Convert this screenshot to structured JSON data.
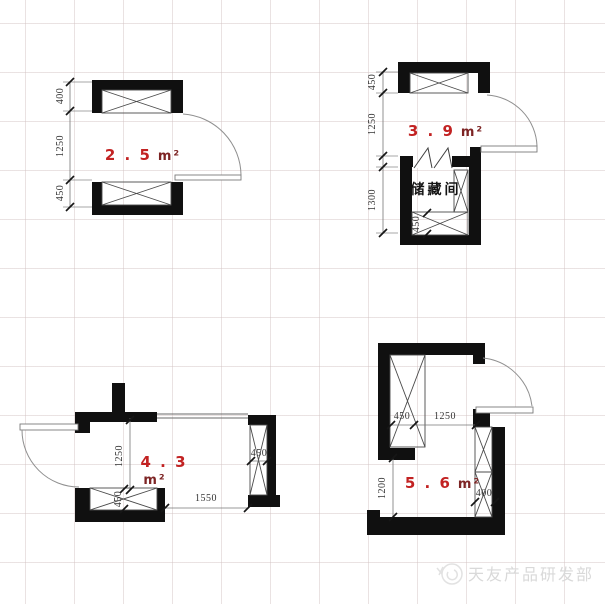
{
  "colors": {
    "wall_black": "#101010",
    "area_red": "#c22222",
    "area_unit_maroon": "#7d2424",
    "dim_text": "#353535",
    "grid_line": "#e6dcdc",
    "watermark_gray": "#d9d9d9"
  },
  "plans": {
    "top_left": {
      "area_value": "2 . 5",
      "area_unit": "m²",
      "dim_shelf_top": "400",
      "dim_middle": "1250",
      "dim_shelf_bottom": "450"
    },
    "top_right": {
      "area_value": "3 . 9",
      "area_unit": "m²",
      "room_label": "储藏间",
      "dim_shelf_top": "450",
      "dim_middle": "1250",
      "dim_room": "1300",
      "dim_inner_shelf": "450"
    },
    "bottom_left": {
      "area_value": "4 . 3",
      "area_unit": "m²",
      "dim_vertical": "1250",
      "dim_shelf_bottom": "450",
      "dim_horizontal": "1550",
      "dim_shelf_right": "450"
    },
    "bottom_right": {
      "area_value": "5 . 6",
      "area_unit": "m²",
      "dim_shelf_left": "450",
      "dim_opening": "1250",
      "dim_vertical": "1200",
      "dim_shelf_right": "400"
    }
  },
  "watermark": {
    "logo": "tianyou-logo",
    "text": "天友产品研发部"
  }
}
